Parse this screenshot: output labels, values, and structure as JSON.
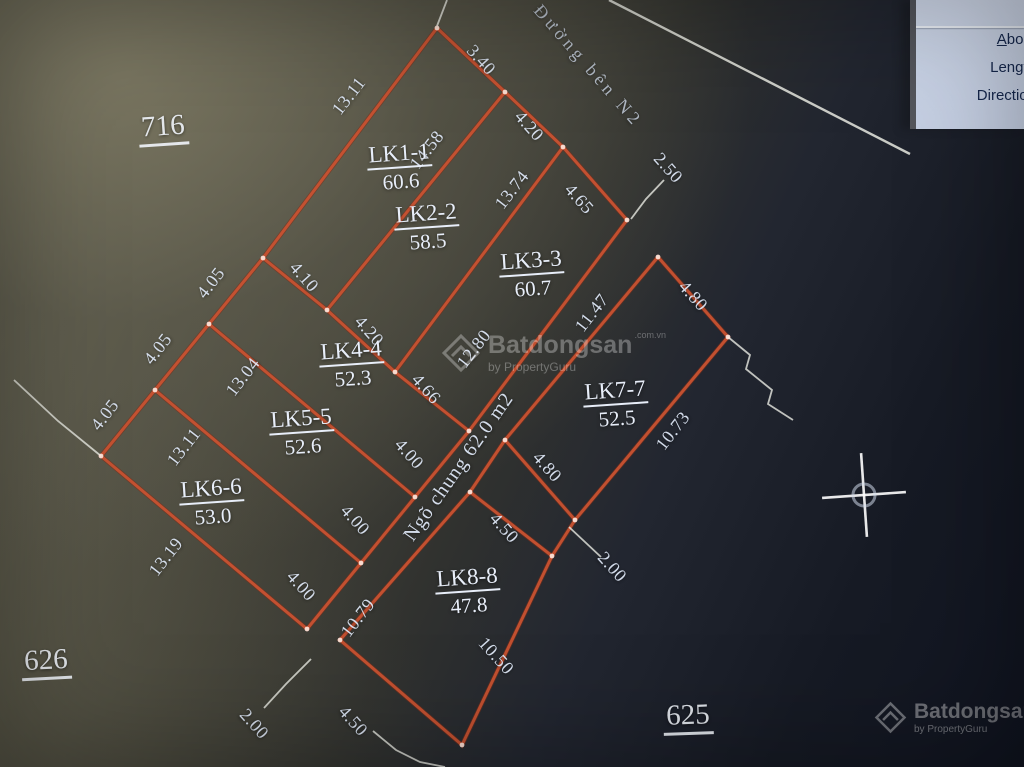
{
  "colors": {
    "red_line": "#c85231",
    "corner_dot": "#ffe9e0",
    "white_line": "#e9eae2",
    "dim_text": "#dce5f4",
    "panel_bg": "#cbd5e8",
    "panel_text": "#16284e"
  },
  "panel": {
    "fields": [
      {
        "label": "About"
      },
      {
        "label": "Length"
      },
      {
        "label": "Direction"
      }
    ]
  },
  "road": {
    "label": "Đường bên N2",
    "label_x": 588,
    "label_y": 66,
    "label_rot": 49,
    "line": [
      [
        609,
        0
      ],
      [
        910,
        154
      ]
    ]
  },
  "plots": [
    {
      "name": "LK1-1",
      "area": "60.6",
      "x": 400,
      "y": 167,
      "rot": -4
    },
    {
      "name": "LK2-2",
      "area": "58.5",
      "x": 427,
      "y": 227,
      "rot": -4
    },
    {
      "name": "LK3-3",
      "area": "60.7",
      "x": 532,
      "y": 274,
      "rot": -4
    },
    {
      "name": "LK4-4",
      "area": "52.3",
      "x": 352,
      "y": 364,
      "rot": -4
    },
    {
      "name": "LK5-5",
      "area": "52.6",
      "x": 302,
      "y": 432,
      "rot": -4
    },
    {
      "name": "LK6-6",
      "area": "53.0",
      "x": 212,
      "y": 502,
      "rot": -4
    },
    {
      "name": "LK7-7",
      "area": "52.5",
      "x": 616,
      "y": 404,
      "rot": -4
    },
    {
      "name": "LK8-8",
      "area": "47.8",
      "x": 468,
      "y": 591,
      "rot": -4
    }
  ],
  "dimensions": [
    {
      "t": "13.11",
      "x": 349,
      "y": 96,
      "r": -52
    },
    {
      "t": "14.58",
      "x": 427,
      "y": 150,
      "r": -52
    },
    {
      "t": "3.40",
      "x": 481,
      "y": 60,
      "r": 48
    },
    {
      "t": "4.20",
      "x": 529,
      "y": 126,
      "r": 48
    },
    {
      "t": "13.74",
      "x": 512,
      "y": 190,
      "r": -52
    },
    {
      "t": "4.65",
      "x": 579,
      "y": 199,
      "r": 48
    },
    {
      "t": "2.50",
      "x": 668,
      "y": 168,
      "r": 48
    },
    {
      "t": "4.80",
      "x": 693,
      "y": 296,
      "r": 48
    },
    {
      "t": "11.47",
      "x": 592,
      "y": 313,
      "r": -52
    },
    {
      "t": "12.80",
      "x": 474,
      "y": 349,
      "r": -52
    },
    {
      "t": "10.73",
      "x": 673,
      "y": 431,
      "r": -52
    },
    {
      "t": "4.80",
      "x": 547,
      "y": 467,
      "r": 48
    },
    {
      "t": "4.10",
      "x": 304,
      "y": 277,
      "r": 48
    },
    {
      "t": "4.20",
      "x": 369,
      "y": 331,
      "r": 48
    },
    {
      "t": "4.66",
      "x": 426,
      "y": 389,
      "r": 48
    },
    {
      "t": "13.04",
      "x": 243,
      "y": 377,
      "r": -52
    },
    {
      "t": "4.05",
      "x": 211,
      "y": 283,
      "r": -52
    },
    {
      "t": "4.05",
      "x": 158,
      "y": 349,
      "r": -52
    },
    {
      "t": "4.05",
      "x": 105,
      "y": 415,
      "r": -52
    },
    {
      "t": "13.11",
      "x": 184,
      "y": 447,
      "r": -52
    },
    {
      "t": "13.19",
      "x": 166,
      "y": 557,
      "r": -52
    },
    {
      "t": "4.00",
      "x": 409,
      "y": 454,
      "r": 48
    },
    {
      "t": "4.00",
      "x": 355,
      "y": 520,
      "r": 48
    },
    {
      "t": "4.00",
      "x": 301,
      "y": 586,
      "r": 48
    },
    {
      "t": "10.79",
      "x": 358,
      "y": 618,
      "r": -52
    },
    {
      "t": "4.50",
      "x": 504,
      "y": 528,
      "r": 48
    },
    {
      "t": "2.00",
      "x": 612,
      "y": 567,
      "r": 48
    },
    {
      "t": "10.50",
      "x": 496,
      "y": 656,
      "r": 48
    },
    {
      "t": "4.50",
      "x": 353,
      "y": 721,
      "r": 48
    },
    {
      "t": "2.00",
      "x": 254,
      "y": 724,
      "r": 48
    }
  ],
  "refs": [
    {
      "t": "716",
      "x": 163,
      "y": 128,
      "r": -4
    },
    {
      "t": "626",
      "x": 46,
      "y": 662,
      "r": -3
    },
    {
      "t": "625",
      "x": 688,
      "y": 717,
      "r": -2
    }
  ],
  "alley": {
    "label": "Ngõ chung 62.0 m2",
    "x": 459,
    "y": 467,
    "r": -55
  },
  "red_polylines": [
    [
      [
        437,
        28
      ],
      [
        505,
        92
      ],
      [
        563,
        147
      ],
      [
        627,
        220
      ]
    ],
    [
      [
        437,
        28
      ],
      [
        263,
        258
      ]
    ],
    [
      [
        505,
        92
      ],
      [
        327,
        310
      ]
    ],
    [
      [
        563,
        147
      ],
      [
        395,
        372
      ]
    ],
    [
      [
        627,
        220
      ],
      [
        469,
        431
      ]
    ],
    [
      [
        263,
        258
      ],
      [
        327,
        310
      ],
      [
        395,
        372
      ],
      [
        469,
        431
      ]
    ],
    [
      [
        263,
        258
      ],
      [
        209,
        324
      ],
      [
        155,
        390
      ],
      [
        101,
        456
      ]
    ],
    [
      [
        209,
        324
      ],
      [
        415,
        497
      ]
    ],
    [
      [
        155,
        390
      ],
      [
        361,
        563
      ]
    ],
    [
      [
        101,
        456
      ],
      [
        307,
        629
      ]
    ],
    [
      [
        469,
        431
      ],
      [
        415,
        497
      ],
      [
        361,
        563
      ],
      [
        307,
        629
      ]
    ],
    [
      [
        658,
        257
      ],
      [
        728,
        337
      ],
      [
        575,
        520
      ],
      [
        505,
        440
      ],
      [
        658,
        257
      ]
    ],
    [
      [
        505,
        440
      ],
      [
        470,
        492
      ]
    ],
    [
      [
        575,
        520
      ],
      [
        552,
        556
      ]
    ],
    [
      [
        470,
        492
      ],
      [
        552,
        556
      ],
      [
        462,
        745
      ],
      [
        340,
        640
      ],
      [
        470,
        492
      ]
    ]
  ],
  "corner_dots": [
    [
      437,
      28
    ],
    [
      505,
      92
    ],
    [
      563,
      147
    ],
    [
      627,
      220
    ],
    [
      658,
      257
    ],
    [
      728,
      337
    ],
    [
      263,
      258
    ],
    [
      327,
      310
    ],
    [
      395,
      372
    ],
    [
      469,
      431
    ],
    [
      209,
      324
    ],
    [
      155,
      390
    ],
    [
      101,
      456
    ],
    [
      415,
      497
    ],
    [
      361,
      563
    ],
    [
      307,
      629
    ],
    [
      505,
      440
    ],
    [
      575,
      520
    ],
    [
      470,
      492
    ],
    [
      552,
      556
    ],
    [
      340,
      640
    ],
    [
      462,
      745
    ]
  ],
  "white_leaders": [
    [
      [
        447,
        0
      ],
      [
        437,
        26
      ]
    ],
    [
      [
        101,
        456
      ],
      [
        58,
        421
      ],
      [
        14,
        380
      ]
    ],
    [
      [
        728,
        337
      ],
      [
        750,
        355
      ],
      [
        746,
        369
      ],
      [
        772,
        390
      ],
      [
        768,
        404
      ],
      [
        793,
        420
      ]
    ],
    [
      [
        664,
        180
      ],
      [
        646,
        199
      ],
      [
        631,
        219
      ]
    ],
    [
      [
        569,
        527
      ],
      [
        601,
        557
      ]
    ],
    [
      [
        311,
        659
      ],
      [
        286,
        684
      ],
      [
        264,
        708
      ]
    ],
    [
      [
        373,
        731
      ],
      [
        396,
        750
      ],
      [
        420,
        762
      ],
      [
        445,
        767
      ]
    ]
  ],
  "crosshair": {
    "x": 864,
    "y": 495,
    "radius": 11,
    "arm": 42,
    "rot": -4
  },
  "watermark_center": {
    "brand": "Batdongsan",
    "tld": ".com.vn",
    "byline": "by PropertyGuru"
  },
  "watermark_corner": {
    "brand": "Batdongsan",
    "tld": "com.vn",
    "byline": "by PropertyGuru"
  }
}
